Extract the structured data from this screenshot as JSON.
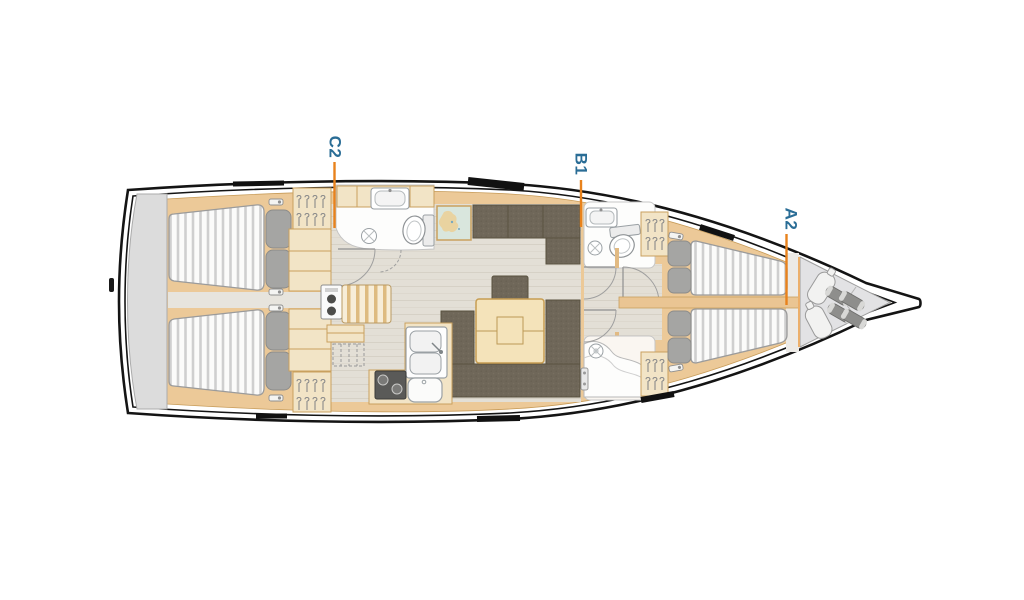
{
  "plan": {
    "section_markers": [
      {
        "id": "C2",
        "text": "C2"
      },
      {
        "id": "B1",
        "text": "B1"
      },
      {
        "id": "A2",
        "text": "A2"
      }
    ],
    "colors": {
      "marker_line": "#E8821C",
      "bulkhead_line": "#ECAF6A",
      "label_text": "#2A6D96",
      "hull_line": "#141414",
      "wood": "#ECC998",
      "cabinet": "#F2E4C6",
      "cabinet_edge": "#C9A05E",
      "floor": "#E3DFD6",
      "upholstery": "#6F6759",
      "mattress_stripe": "#CFCFCF",
      "pillow": "#A5A5A3",
      "fixture_white": "#FDFDFD",
      "fixture_outline": "#9AA0A4",
      "swim_platform": "#DCDCDC",
      "bow_locker": "#E2E2E4",
      "table_wood": "#F4E3BA"
    }
  }
}
